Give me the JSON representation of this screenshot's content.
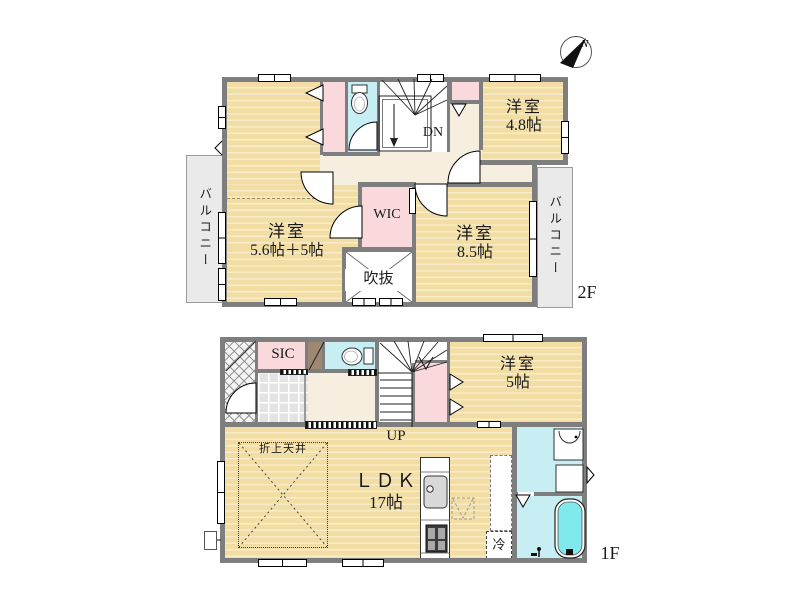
{
  "compass": {
    "north": "N"
  },
  "floor2": {
    "label": "2F",
    "balcony_left": "バルコニー",
    "balcony_right": "バルコニー",
    "stairs_label": "DN",
    "room_main": {
      "name": "洋室",
      "size": "5.6帖＋5帖"
    },
    "room_85": {
      "name": "洋室",
      "size": "8.5帖"
    },
    "room_48": {
      "name": "洋室",
      "size": "4.8帖"
    },
    "wic_label": "WIC",
    "void_label": "吹抜"
  },
  "floor1": {
    "label": "1F",
    "stairs_label": "UP",
    "sic_label": "SIC",
    "room_5": {
      "name": "洋室",
      "size": "5帖"
    },
    "ldk": {
      "name": "ＬＤＫ",
      "size": "17帖"
    },
    "ceiling_label": "折上天井",
    "fridge_label": "冷"
  },
  "colors": {
    "wood_floor": "#f2dea4",
    "wood_stripe": "#f8ecc8",
    "closet_pink": "#f9d9dc",
    "wet_area_cyan": "#c6eef3",
    "hall_cream": "#f6efdf",
    "wall_gray": "#7e7e7e",
    "balcony_gray": "#eaeaea",
    "bath_water": "#7fe9ee",
    "entrance_brown": "#9e8871"
  }
}
